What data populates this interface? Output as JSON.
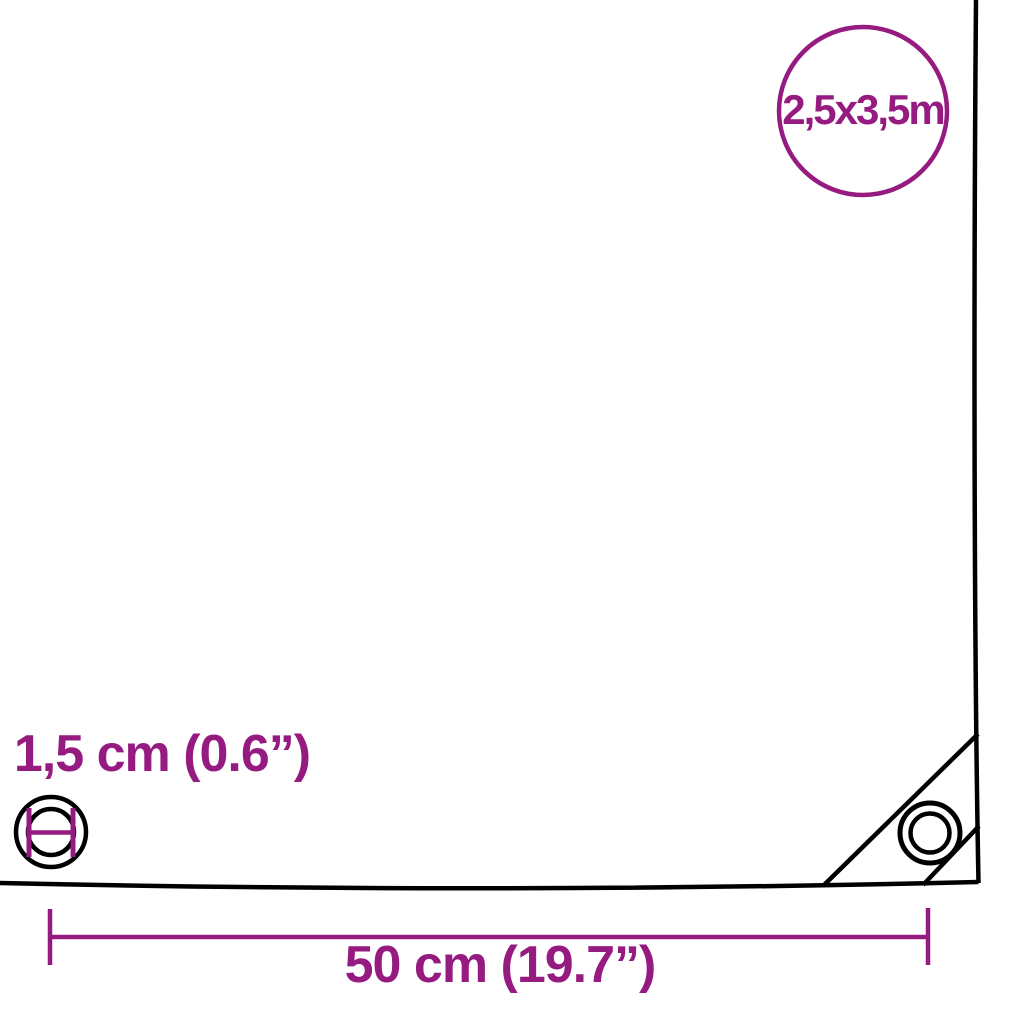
{
  "diagram": {
    "badge": {
      "size_label": "2,5x3,5m"
    },
    "labels": {
      "eyelet_diameter": "1,5 cm (0.6”)",
      "eyelet_spacing": "50 cm (19.7”)"
    },
    "icons": {
      "size_badge": "size-badge-circle-icon",
      "eyelet": "eyelet-icon",
      "eyelet_diameter": "eyelet-diameter-icon",
      "dimension": "dimension-line-icon"
    },
    "colors": {
      "accent": "#951b81",
      "line": "#000000",
      "background": "#ffffff"
    }
  }
}
